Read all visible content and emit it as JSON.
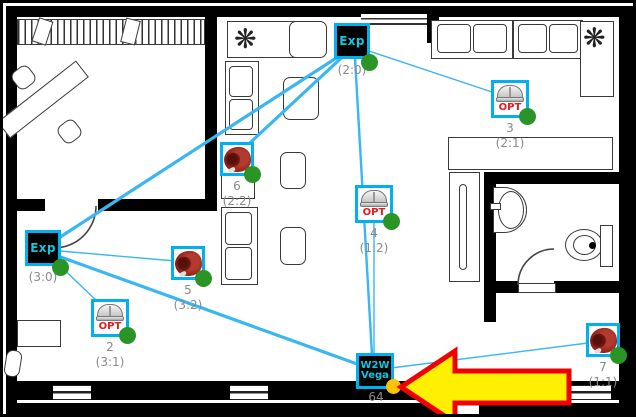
{
  "title": "Wireless fire alarm system floor plan",
  "colors": {
    "node_border": "#00b0f0",
    "link_line": "#3ab6f0",
    "online_dot": "#2a9427",
    "panel_dot": "#ffc300",
    "arrow_fill": "#ffef00",
    "arrow_border": "#f00000",
    "address_text": "#8a8a8a",
    "opt_text": "#e31b1b"
  },
  "devices": [
    {
      "key": "expander-top",
      "type": "expander",
      "label": "Exp",
      "address": "(2:0)"
    },
    {
      "key": "optical-3",
      "type": "optical-detector",
      "label": "OPT",
      "number": "3",
      "address": "(2:1)"
    },
    {
      "key": "sounder-6",
      "type": "sounder",
      "number": "6",
      "address": "(2:2)"
    },
    {
      "key": "optical-4",
      "type": "optical-detector",
      "label": "OPT",
      "number": "4",
      "address": "(1:2)"
    },
    {
      "key": "expander-left",
      "type": "expander",
      "label": "Exp",
      "address": "(3:0)"
    },
    {
      "key": "sounder-5",
      "type": "sounder",
      "number": "5",
      "address": "(3:2)"
    },
    {
      "key": "optical-2",
      "type": "optical-detector",
      "label": "OPT",
      "number": "2",
      "address": "(3:1)"
    },
    {
      "key": "sounder-7",
      "type": "sounder",
      "number": "7",
      "address": "(1:1)"
    },
    {
      "key": "panel",
      "type": "control-panel",
      "label_line1": "W2W",
      "label_line2": "Vega",
      "number": "64"
    }
  ],
  "connections": [
    {
      "from": "Exp (2:0)",
      "to": "Sounder 6 (2:2)"
    },
    {
      "from": "Exp (2:0)",
      "to": "Exp (3:0)"
    },
    {
      "from": "Exp (2:0)",
      "to": "W2W Vega"
    },
    {
      "from": "Exp (2:0)",
      "to": "OPT 3 (2:1)"
    },
    {
      "from": "Exp (3:0)",
      "to": "Sounder 5 (3:2)"
    },
    {
      "from": "Exp (3:0)",
      "to": "OPT 2 (3:1)"
    },
    {
      "from": "Exp (3:0)",
      "to": "W2W Vega"
    },
    {
      "from": "OPT 4 (1:2)",
      "to": "W2W Vega"
    },
    {
      "from": "W2W Vega",
      "to": "Sounder 7 (1:1)"
    }
  ],
  "annotation": {
    "type": "arrow",
    "direction": "left",
    "target": "W2W Vega panel"
  }
}
